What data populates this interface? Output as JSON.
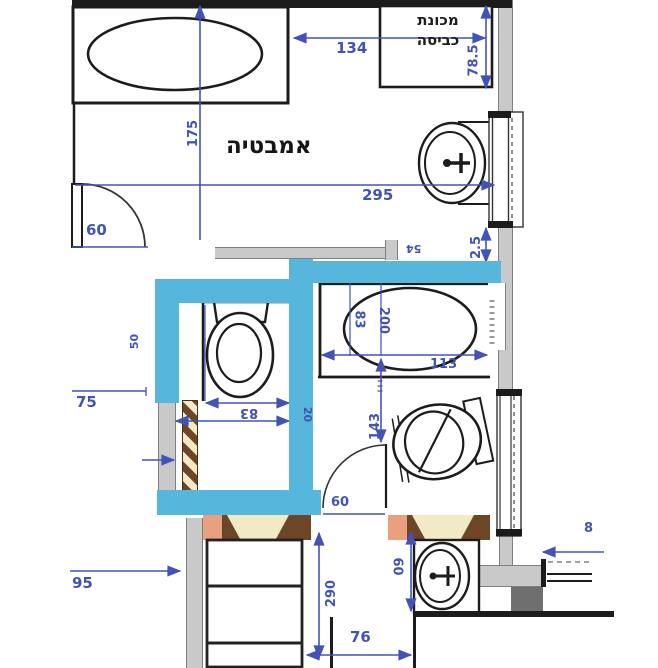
{
  "plan": {
    "room_label": "אמבטיה",
    "washer_label_line1": "מכונת",
    "washer_label_line2": "כביסה"
  },
  "dims": {
    "d134": "134",
    "d78_5": "78.5",
    "d175": "175",
    "d295": "295",
    "d2_5": "2.5",
    "d60_top_door": "60",
    "d54": "54",
    "d50": "50",
    "d83_tub": "83",
    "d200": "200",
    "d113": "113",
    "d143": "143",
    "d83_niche": "83",
    "d20": "20",
    "d75": "75",
    "d95": "95",
    "d290": "290",
    "d76": "76",
    "d60_sink": "60",
    "d60_lower_door": "60",
    "d8_partial": "8"
  },
  "colors": {
    "ink": "#1c1c1c",
    "dim": "#4353b5",
    "highlight": "#57b6dc",
    "wallGray": "#c9c9c9",
    "wallEdge": "#7e7e7e",
    "brown": "#6d4527",
    "cream": "#f2e9c5",
    "salmon": "#e9a07e",
    "darkGray": "#6f6f6f"
  }
}
